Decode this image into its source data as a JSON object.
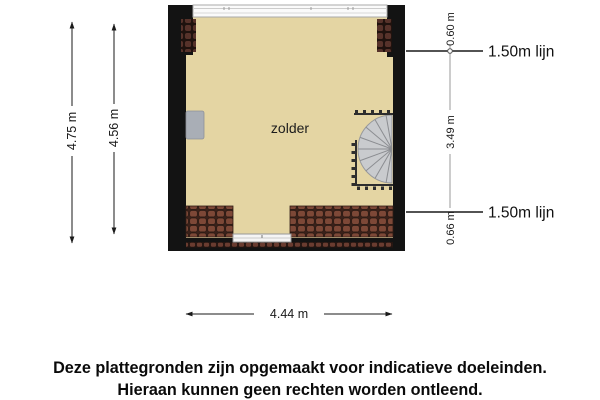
{
  "plan": {
    "room_label": "zolder"
  },
  "dimensions": {
    "left_outer_label": "4.75 m",
    "left_inner_label": "4.56 m",
    "right_top_label": "0.60 m",
    "right_middle_label": "3.49 m",
    "right_bottom_label": "0.66 m",
    "marker_top_label": "1.50m lijn",
    "marker_bottom_label": "1.50m lijn",
    "bottom_label": "4.44 m"
  },
  "footer": {
    "line1": "Deze plattegronden zijn opgemaakt voor indicatieve doeleinden.",
    "line2": "Hieraan kunnen geen rechten worden ontleend."
  },
  "colors": {
    "floor": "#e4d5a3",
    "wall": "#131313",
    "roof_tile": "#7d4837",
    "roof_tile_dark": "#56322a",
    "stair_fill": "#c9cbce",
    "chimney": "#a9aeb6",
    "dim_gray": "#9a9a9a"
  }
}
